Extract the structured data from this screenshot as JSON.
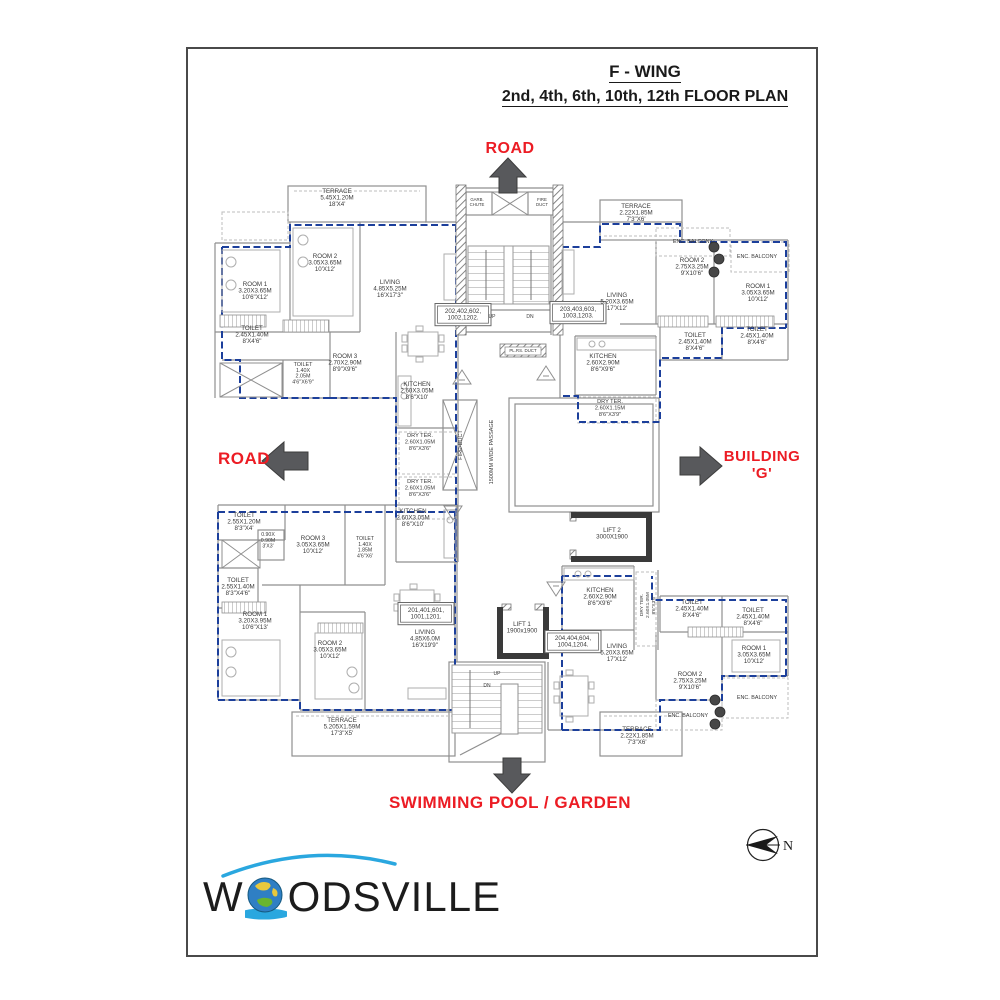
{
  "title": {
    "line1": "F - WING",
    "line2": "2nd, 4th, 6th, 10th, 12th FLOOR PLAN"
  },
  "annotations": {
    "road_top": "ROAD",
    "road_left": "ROAD",
    "building_right_line1": "BUILDING",
    "building_right_line2": "'G'",
    "bottom": "SWIMMING POOL / GARDEN"
  },
  "compass": {
    "label": "N"
  },
  "logo": {
    "part1": "W",
    "part2": "ODSVILLE"
  },
  "colors": {
    "accent_red": "#ec1c24",
    "boundary_blue": "#1c3f9b",
    "wall_gray": "#8f8f8f",
    "lift_dark": "#3a3a3a"
  },
  "plan": {
    "labels": [
      {
        "x": 337,
        "y": 193,
        "lines": [
          "TERRACE",
          "5.45X1.20M",
          "18'X4'"
        ]
      },
      {
        "x": 325,
        "y": 258,
        "lines": [
          "ROOM  2",
          "3.05X3.65M",
          "10'X12'"
        ]
      },
      {
        "x": 255,
        "y": 286,
        "lines": [
          "ROOM  1",
          "3.20X3.65M",
          "10'6\"X12'"
        ]
      },
      {
        "x": 390,
        "y": 284,
        "lines": [
          "LIVING",
          "4.85X5.25M",
          "16'X17'3\""
        ]
      },
      {
        "x": 252,
        "y": 330,
        "lines": [
          "TOILET",
          "2.45X1.40M",
          "8'X4'6\""
        ]
      },
      {
        "x": 345,
        "y": 358,
        "lines": [
          "ROOM  3",
          "2.70X2.90M",
          "8'9\"X9'6\""
        ]
      },
      {
        "x": 303,
        "y": 366,
        "lines": [
          "TOILET",
          "1.40X",
          "2.05M",
          "4'6\"X6'9\""
        ],
        "s": 5.4,
        "lh": 5.8
      },
      {
        "x": 417,
        "y": 386,
        "lines": [
          "KITCHEN",
          "2.60X3.05M",
          "8'6\"X10'"
        ]
      },
      {
        "x": 420,
        "y": 437,
        "lines": [
          "DRY  TER.",
          "2.60X1.05M",
          "8'6\"X3'6\""
        ],
        "s": 5.6
      },
      {
        "x": 420,
        "y": 483,
        "lines": [
          "DRY  TER.",
          "2.60X1.05M",
          "8'6\"X3'6\""
        ],
        "s": 5.6
      },
      {
        "x": 413,
        "y": 513,
        "lines": [
          "KITCHEN",
          "2.60X3.05M",
          "8'6\"X10'"
        ]
      },
      {
        "x": 463,
        "y": 313,
        "lines": [
          "202,402,602,",
          "1002,1202."
        ],
        "box": true
      },
      {
        "x": 578,
        "y": 311,
        "lines": [
          "203,403,603,",
          "1003,1203."
        ],
        "box": true
      },
      {
        "x": 492,
        "y": 318,
        "lines": [
          "UP"
        ],
        "s": 5
      },
      {
        "x": 530,
        "y": 318,
        "lines": [
          "DN"
        ],
        "s": 5
      },
      {
        "x": 477,
        "y": 201,
        "lines": [
          "GARB.",
          "CHUTE"
        ],
        "s": 4.3,
        "lh": 4.8
      },
      {
        "x": 542,
        "y": 201,
        "lines": [
          "FIRE",
          "DUCT"
        ],
        "s": 4.3,
        "lh": 4.8
      },
      {
        "x": 523,
        "y": 352,
        "lines": [
          "PL.RS.  DUCT"
        ],
        "s": 4.4
      },
      {
        "x": 460,
        "y": 445,
        "lines": [
          "FIRE-DUCT"
        ],
        "v": true,
        "s": 5.5
      },
      {
        "x": 491,
        "y": 452,
        "lines": [
          "1500MM  WIDE  PASSAGE"
        ],
        "v": true,
        "s": 5.5
      },
      {
        "x": 636,
        "y": 208,
        "lines": [
          "TERRACE",
          "2.22X1.85M",
          "7'3\"X6'"
        ]
      },
      {
        "x": 693,
        "y": 243,
        "lines": [
          "ENC.  BALCONY"
        ],
        "s": 5.4
      },
      {
        "x": 692,
        "y": 262,
        "lines": [
          "ROOM  2",
          "2.75X3.25M",
          "9'X10'6\""
        ]
      },
      {
        "x": 757,
        "y": 258,
        "lines": [
          "ENC.  BALCONY"
        ],
        "s": 5.4
      },
      {
        "x": 758,
        "y": 288,
        "lines": [
          "ROOM  1",
          "3.05X3.65M",
          "10'X12'"
        ]
      },
      {
        "x": 617,
        "y": 297,
        "lines": [
          "LIVING",
          "5.20X3.65M",
          "17'X12'"
        ]
      },
      {
        "x": 695,
        "y": 337,
        "lines": [
          "TOILET",
          "2.45X1.40M",
          "8'X4'6\""
        ]
      },
      {
        "x": 757,
        "y": 331,
        "lines": [
          "TOILET",
          "2.45X1.40M",
          "8'X4'6\""
        ]
      },
      {
        "x": 603,
        "y": 358,
        "lines": [
          "KITCHEN",
          "2.60X2.90M",
          "8'6\"X9'6\""
        ]
      },
      {
        "x": 610,
        "y": 403,
        "lines": [
          "DRY  TER.",
          "2.60X1.15M",
          "8'6\"X3'9\""
        ],
        "s": 5.6
      },
      {
        "x": 244,
        "y": 517,
        "lines": [
          "TOILET",
          "2.55X1.20M",
          "8'3\"X4'"
        ]
      },
      {
        "x": 268,
        "y": 536,
        "lines": [
          "0.90X",
          "0.90M",
          "3'X3'"
        ],
        "s": 5.2,
        "lh": 5.8
      },
      {
        "x": 313,
        "y": 540,
        "lines": [
          "ROOM  3",
          "3.05X3.65M",
          "10'X12'"
        ]
      },
      {
        "x": 365,
        "y": 540,
        "lines": [
          "TOILET",
          "1.40X",
          "1.85M",
          "4'6\"X6'"
        ],
        "s": 5.2,
        "lh": 5.8
      },
      {
        "x": 238,
        "y": 582,
        "lines": [
          "TOILET",
          "2.55X1.40M",
          "8'3\"X4'6\""
        ]
      },
      {
        "x": 255,
        "y": 616,
        "lines": [
          "ROOM  1",
          "3.20X3.95M",
          "10'6\"X13'"
        ]
      },
      {
        "x": 330,
        "y": 645,
        "lines": [
          "ROOM  2",
          "3.05X3.65M",
          "10'X12'"
        ]
      },
      {
        "x": 425,
        "y": 634,
        "lines": [
          "LIVING",
          "4.85X6.0M",
          "16'X19'9\""
        ]
      },
      {
        "x": 426,
        "y": 612,
        "lines": [
          "201,401,601,",
          "1001,1201."
        ],
        "box": true
      },
      {
        "x": 342,
        "y": 722,
        "lines": [
          "TERRACE",
          "5.205X1.59M",
          "17'3\"X5'"
        ]
      },
      {
        "x": 612,
        "y": 532,
        "lines": [
          "LIFT  2",
          "3000X1900"
        ]
      },
      {
        "x": 522,
        "y": 626,
        "lines": [
          "LIFT  1",
          "1900x1900"
        ]
      },
      {
        "x": 600,
        "y": 592,
        "lines": [
          "KITCHEN",
          "2.60X2.90M",
          "8'6\"X9'6\""
        ]
      },
      {
        "x": 647,
        "y": 605,
        "lines": [
          "DRY  TER.",
          "2.60X1.05M",
          "8'6\"X3'6\""
        ],
        "v": true,
        "s": 4.8,
        "lh": 5.8
      },
      {
        "x": 573,
        "y": 640,
        "lines": [
          "204,404,604,",
          "1004,1204."
        ],
        "box": true
      },
      {
        "x": 617,
        "y": 648,
        "lines": [
          "LIVING",
          "5.20X3.65M",
          "17'X12'"
        ]
      },
      {
        "x": 692,
        "y": 604,
        "lines": [
          "TOILET",
          "2.45X1.40M",
          "8'X4'6\""
        ]
      },
      {
        "x": 753,
        "y": 612,
        "lines": [
          "TOILET",
          "2.45X1.40M",
          "8'X4'6\""
        ]
      },
      {
        "x": 754,
        "y": 650,
        "lines": [
          "ROOM  1",
          "3.05X3.65M",
          "10'X12'"
        ]
      },
      {
        "x": 690,
        "y": 676,
        "lines": [
          "ROOM  2",
          "2.75X3.25M",
          "9'X10'6\""
        ]
      },
      {
        "x": 757,
        "y": 699,
        "lines": [
          "ENC.  BALCONY"
        ],
        "s": 5.4
      },
      {
        "x": 688,
        "y": 717,
        "lines": [
          "ENC.  BALCONY"
        ],
        "s": 5.4
      },
      {
        "x": 637,
        "y": 731,
        "lines": [
          "TERRACE",
          "2.22X1.85M",
          "7'3\"X6'"
        ]
      },
      {
        "x": 497,
        "y": 675,
        "lines": [
          "UP"
        ],
        "s": 5
      },
      {
        "x": 487,
        "y": 687,
        "lines": [
          "DN"
        ],
        "s": 5
      }
    ]
  }
}
